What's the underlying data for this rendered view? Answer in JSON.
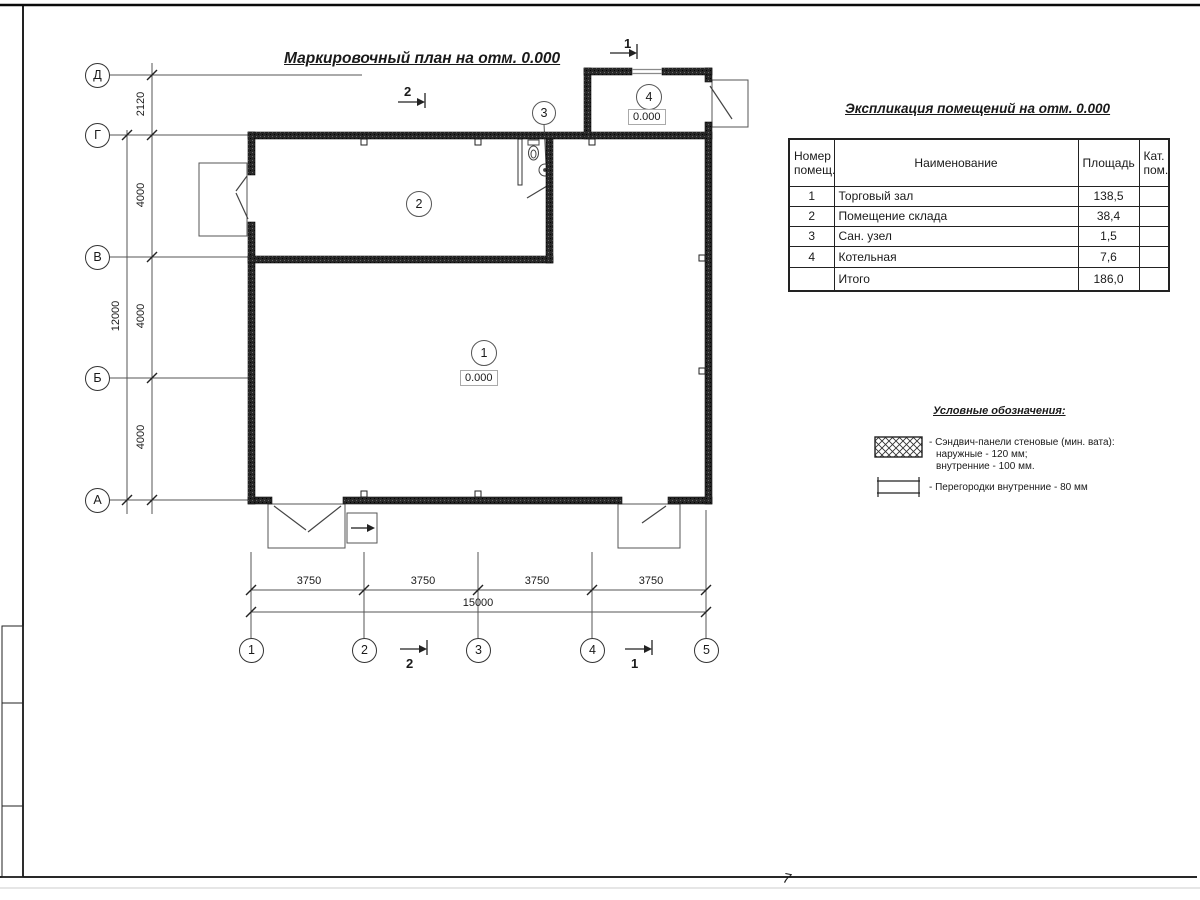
{
  "sheet": {
    "plan_title": "Маркировочный план на отм. 0.000",
    "corner_mark": "7"
  },
  "plan": {
    "rooms": {
      "r1": {
        "num": "1",
        "elev": "0.000"
      },
      "r2": {
        "num": "2"
      },
      "r3": {
        "num": "3"
      },
      "r4": {
        "num": "4",
        "elev": "0.000"
      }
    },
    "sections": {
      "s1": "1",
      "s2": "2"
    }
  },
  "axes": {
    "rows": [
      "Д",
      "Г",
      "В",
      "Б",
      "А"
    ],
    "cols": [
      "1",
      "2",
      "3",
      "4",
      "5"
    ]
  },
  "dims": {
    "left_chain": [
      "2120",
      "4000",
      "4000",
      "4000"
    ],
    "left_total": "12000",
    "bottom_chain": [
      "3750",
      "3750",
      "3750",
      "3750"
    ],
    "bottom_total": "15000"
  },
  "table": {
    "title": "Экспликация помещений на отм. 0.000",
    "headers": [
      "Номер помещ.",
      "Наименование",
      "Площадь",
      "Кат. пом."
    ],
    "rows": [
      [
        "1",
        "Торговый зал",
        "138,5",
        ""
      ],
      [
        "2",
        "Помещение склада",
        "38,4",
        ""
      ],
      [
        "3",
        "Сан. узел",
        "1,5",
        ""
      ],
      [
        "4",
        "Котельная",
        "7,6",
        ""
      ],
      [
        "",
        "Итого",
        "186,0",
        ""
      ]
    ]
  },
  "legend": {
    "title": "Условные обозначения:",
    "item1": {
      "line1": "- Сэндвич-панели стеновые (мин. вата):",
      "line2": "наружные - 120 мм;",
      "line3": "внутренние - 100 мм."
    },
    "item2": {
      "line1": "- Перегородки внутренние - 80 мм"
    }
  }
}
